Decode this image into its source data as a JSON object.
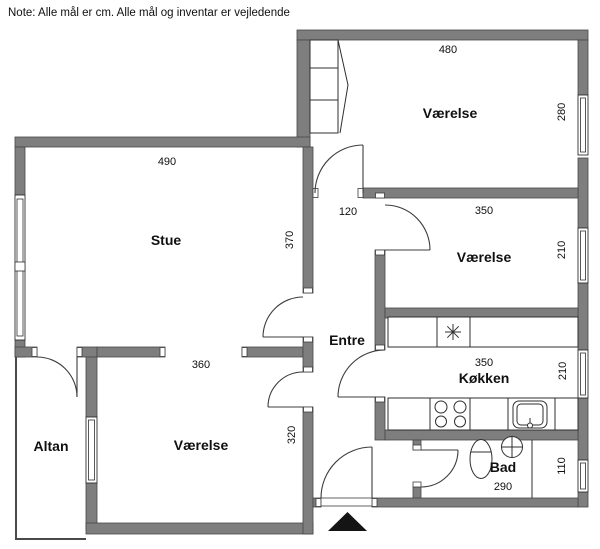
{
  "note": "Note: Alle mål er cm. Alle mål og inventar er vejledende",
  "rooms": {
    "vaerelse_top": {
      "label": "Værelse",
      "width": "480",
      "depth": "280"
    },
    "stue": {
      "label": "Stue",
      "width": "490",
      "depth": "370"
    },
    "vaerelse_mid": {
      "label": "Værelse",
      "width": "350",
      "depth": "210"
    },
    "entre": {
      "label": "Entre",
      "width": "120"
    },
    "koekken": {
      "label": "Køkken",
      "width": "350",
      "depth": "210"
    },
    "bad": {
      "label": "Bad",
      "width": "290",
      "depth": "110"
    },
    "vaerelse_bottom": {
      "label": "Værelse",
      "width": "360",
      "depth": "320"
    },
    "altan": {
      "label": "Altan"
    }
  },
  "icons": {
    "freezer": "freezer-star-icon",
    "stove": "stove-burners-icon",
    "kitchen_sink": "kitchen-sink-icon",
    "toilet": "toilet-icon",
    "washbasin": "washbasin-icon",
    "wardrobe": "wardrobe-icon",
    "entrance_marker": "entrance-arrow-icon"
  },
  "colors": {
    "wall": "#7e7e7e",
    "wall_outline": "#474747",
    "line": "#2f2f2f",
    "background": "#ffffff",
    "entrance_marker": "#141414"
  }
}
